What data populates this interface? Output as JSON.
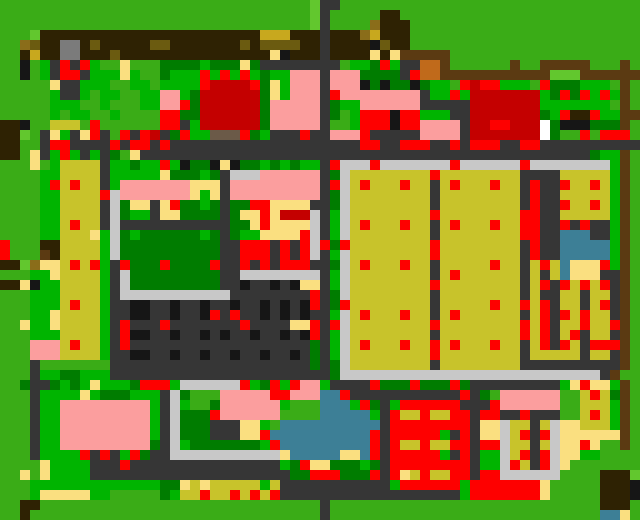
{
  "map": {
    "kind": "tile-world-map",
    "cols": 64,
    "rows": 52,
    "tile_size": 10,
    "palette": {
      "G": "#3aac17",
      "L": "#62c72e",
      "M": "#00b400",
      "D": "#007c00",
      "Y": "#c8c32b",
      "W": "#fadf80",
      "O": "#8a6d1a",
      "o": "#c8a81e",
      "b": "#6b5b10",
      "B": "#2e2203",
      "N": "#5b3a12",
      "n": "#c06a1b",
      "h": "#6b5a48",
      "K": "#161616",
      "R": "#363636",
      "S": "#c8c8c8",
      "H": "#7b7b7b",
      "P": "#fb9e9e",
      "C": "#c40000",
      "r": "#fe0000",
      "A": "#3d7f96",
      "x": "#ffffff"
    },
    "palette_legend": {
      "G": "grass",
      "L": "light-grass",
      "M": "bright-green-crop",
      "D": "dark-green-hedge",
      "Y": "yellow-field",
      "W": "sand-pale-yellow",
      "O": "gold-dirt",
      "o": "bright-gold",
      "b": "olive-soil-dot",
      "B": "dark-brown-soil",
      "N": "brown-fence",
      "n": "orange-crate",
      "h": "taupe-tile",
      "K": "black-car",
      "R": "road-asphalt",
      "S": "sidewalk-gray",
      "H": "gray-building",
      "P": "pink-building",
      "C": "dark-red-building",
      "r": "red-item",
      "A": "water",
      "x": "white-tile"
    },
    "tiles": [
      "GGGGGGGGGGGGGGGGGGGGGGGGGGGGGGGLRRGGGGGGGGGGGGGGGGGGGGGGGGGGGGGG",
      "GGGGGGGGGGGGGGGGGGGGGGGGGGGGGGGLRGGGGGBBGGGGGGGGGGGGGGGGGGGGGGGG",
      "GGGGGGGGGGGGGGGGGGGGGGGGGGGGGGGLRGGGGOBBBGGGGGGGGGGGGGGGGGGGGGGG",
      "GGGLBBBBBBBBBBBBBBBBBBBBBBoooBBBRBBBOoBBBGGGGGGGGGGGGGGGGGGGGGGG",
      "GGObBBHHBbBBBBBbbBBBBBBBbBbbbbBBRBBBBKbBBGGGGGGGGGGGGGGGGGGGGGGG",
      "GGBoBBHHBBBbBBBBBBBBBBBBBBBWKBBBRBBBBWBWNNNNNGGGGGGGGGGGGGGGGGGG",
      "GGKGMRrRrMGGWGGGDDDDMDDDWDRRRRRRRRGMMDrMRRnnNGGGGGGNGGNNNNNGGGNG",
      "GGKGMRrrRMMMWMGGDMMMrMrMrMDMMPPPRPPPDDDDRrnnNNNNNNNNNNNLLLNNNNNN",
      "GGGGGWRRMMMGGMMGMMMMrCCCCrDWMPPPRPPPKDKDDKDMMGrCrrMMMGrDDDMMMGNG",
      "GGGGGMRRMGMMGGMMPPMDCCCCCCDWMPPPRrPPPPPPPPRMMrMCCCCCCCMDrDrMrMNG",
      "GGGGGMMMGGMGGGMMPPrDCCCCCCDPPPPPRDMMPPPPPPRRRRRCCCCCCCMMMMMMMGNG",
      "GGGGGMGMMGGMGGGGrrDDCCCCCCDPPPPPRDGMrrrKrrMMMRRCCCCCCCDMrBBrMMNN",
      "BBKGGYYYGrGGGGGGrrRMCCCCCCDPPPPPRGGMrrrKrrPPPPRCCrrCCCxDKKKDDDNG",
      "BBLGRWMRWrRGrRrCRDrMMhhhrDMRRRrRRPPPrRRRRRPPPPRCCCCCCCxDGGrGrrrG",
      "BBGGRrrRRRRrRrrRrRRRRRRRRRRRRRRRRRRRrrRRrrrRRrRrrrRRrrRRRRRRRRRR",
      "BBGWRMrMRMRDGWRRRRRRRRRRRRRRRRRRRRRRRRRRRRRRRRRRRRRRRRRRRRRDMMNG",
      "GGGWGMYYYYRMMDMMrMKDDKWKDDMDMDMMRrSSSrSSSSSSSrSSSSSSrSSSSSSSSMNG",
      "GGGGMMYYYYRMMMMMWDDDMDRSSSPPPPPPRDSYYYYYYYYrYYYYYYYYRRRRYYYYYMNG",
      "GGGGMrYrYYRMPPPPPPPWWWRPPPPPPPPPRrSYrYYYrYYRYrYYYrYYRrRRrYYrYMNG",
      "GGGGMMYYYYrSPPPPPPPWMWRPPPPPPPPPRDSYYYYYYYYRYYYYYYYYRrRRYYYYYMNG",
      "GGGGMMYYYYRSDWWRWrDDMDRDDrrWWWWRRDSYYYYYYYYRYYYYYYYYRrRRrYYrYMNG",
      "GGGGMMYYYYRSDMMRWWDDDDRDWWrWCCCSRMSYYYYYYYYrYYYYYYYYrrRRYYYYYMNG",
      "GGGGMMYrYYRSRRRRRRRRRRRDDWrWWWWSRMSYrYYYrYYRYrYYYrYYrrRRrRrRRMNG",
      "GGGGMMYYYWMSDMDDDDDDMDRDMMWWWWrSRMSYYYYYYYYRYYYYYYYYrrRRAAARRMNG",
      "rGGGBBYYYYMSDDDDDDDDDDRRrrrRrRrSrDrYYYYYYYYrYYYYYYYYRrRRAAAAAMNG",
      "rGGGNBYYYYMSDDDDDDDDDDRRrrrRrRrSRMSYYYYYYYYrYYYYYYYYRrRRAAAAAMNG",
      "BBLOWWYrYrMRrDDDrDDDDrRRrRrRrrrRRDSYrYYYrYYRYYYYYrYYRYrYAWWWrMNG",
      "GGGMMWYYYYMRSDDDDDDDDDRRSSSSSSSSRMSYYYYYYYYRYrYYYYYYRYRYAWWWRRNG",
      "BBWKMMYYYYMRSDDDDDDDDDRRKRRKRKWWRMSYYYYYYYYrYYYYYYYYRYrRrYrYrRNG",
      "GGGMMMYYYYMRSSSSSSSSSSSRRRRRRRRrRDSYYYYYYYYRYYYYYYYYRYRRYYRYYRNG",
      "GGGMMMYrYYMRRKKRRKRRKRRKRRKRKRKrRDrYYYYYYYYRYYYYYrYYrYrRYYRYrRNG",
      "GGGMMWYYYYMRRKKRRKRRKrRrRRKRKRKRRMSYrYYYrYYRYrYYYYYYRYrRrYrYYRNG",
      "GGWMMWYYYYMRrRRRrRRRRRRRrRRRRWWrRrSYYYYYYYYrYYYYYYYYrYrRYYrYYrNG",
      "GGGMMMYYYYMRrKKRRKRRKRKRRKRRKRKrRMSYYYYYYYYRYYYYYYYYrYrRYrRYYRNG",
      "GGGPPPYrYYMRrRRRRRRRRRRRRRRRRRRDRMSYrYYYrYYrYrYYYrYYRYrRrYRrrrNG",
      "GGGPPPYYYYMRRKKRRKRRKRRKRRKRRKRDRMSYYYYYYYYrYYYYYYYYRYYYYYRYYRNG",
      "GGGRGGGGGGGRRRRRRRRRRRRRRRRRRRRDRDSYYYYYYYYRYYYYYYYYRRRRRRRRRRNG",
      "GGGRMMDDMMMRRRRRRRRRRRRRRRRRRRRRRDSSSSSSSSSSSSSSSSSSSSSSSSSSRNG",
      "GGDRRDMDMWMMMDrrrMSSSSSSrMDrMrPPMRRRRrDDDrDDDrDRRRRRRRRRMWrWWMNG",
      "GGGRMMMMWMDDDMMMRSDGGGPPPPPrrPPPAArRRRRRRRRRRRrRDGPPPPPPGGYrYDNG",
      "GGGRMMPPPPPPPPPMRSMGGDPPPPPPMGGGAAAMrDRMrrrrrrRRRrPPPPPPGGYYYMNG",
      "GGGRMMPPPPPPPPPMRSDDDrPPPPPPGGGGAAAAAMRrYYrYYrrRrrRRrRRRGGYrYMNG",
      "GGGRMMPPPPPPPPPMRSDDDRRRWWMGAAAAAAAAAARrrrrrrrrRWWSYYRYSWWYYYMNG",
      "GGGRMMPPPPPPPPPMRSDDDRRRWWrAAAAAAAAAArRrrrrrMRrRWWSYrRrSWWWWWWNG",
      "GGGRMMPPPPPPPPPDRSMDDDDDDDMrAAAAAAAAArRrYYrYYrrRrrSYYRYSWWrWGGNG",
      "GGGRMMMMrRrRMrDRRSSSSSSSSSSSWAAAAAWWArRrrrrrMRrRMMSYrRrSWWMMGGGG",
      "GGGGWMMMMRRRrRRRRRRRRRRRRRRRMDrWWDDDMDRrrrrrrrrRMMSrYRrSWGGGGGGG",
      "GGWGWMMMMRRRRRRRRRRRRRRRRRRRRDDrrrDDDrRrWYrYYrrRrrSSSSSSGGGGBBBL",
      "GGGMMMMMMMMMMMMMDDWYWYYYYYMYRRRRRRRRRRRMrrrrrrMrrrrrrrWGGGGGBBBK",
      "GGGMWWWWWMMGGGGGDMYYrYYrYrYrRRRRRRRRRRRRRRRRRRMrrrrrrrWGGGGGBBBK",
      "GGBBGGGGGGGGGGGGGGGGGGGGGGGGGGGGRGGGGGGGGGGGGGGGGGGGGGGGGGGGBBBG",
      "GGBGGGGGGGGGGGGGGGGGGGGGGGGGGGGGRGGGGGGGGGGGGGGGGGGGGGGGGGGGAAWG",
      "GGBGGGGGGGGGGGGGGGGGGGGGGGGGGGGGRGGGGGGGGGGGGGGGGGGGGGGGGGGGAAWG"
    ]
  }
}
